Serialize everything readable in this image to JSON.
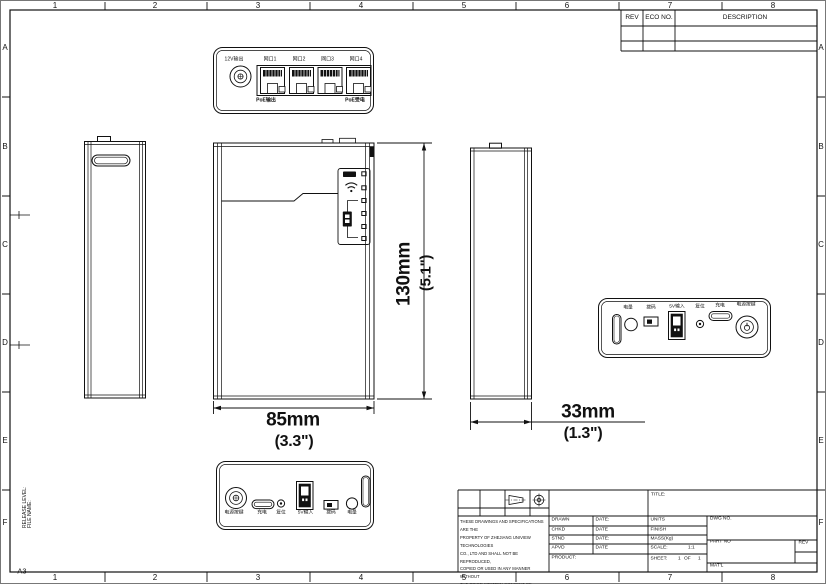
{
  "sheet": {
    "size": "A3",
    "release_level": "RELEASE LEVEL:",
    "file_name": "FILE NAME:",
    "cols": [
      "1",
      "2",
      "3",
      "4",
      "5",
      "6",
      "7",
      "8"
    ],
    "rows": [
      "A",
      "B",
      "C",
      "D",
      "E",
      "F"
    ]
  },
  "rev_table": {
    "rev": "REV",
    "eco_no": "ECO NO.",
    "description": "DESCRIPTION"
  },
  "top_view": {
    "dc_jack": "12V输出",
    "ports": [
      "网口1",
      "网口2",
      "网口3",
      "网口4"
    ],
    "poe_left": "PoE输出",
    "poe_right": "PoE受电"
  },
  "ports_view": {
    "battery": "电量",
    "switch": "拨码",
    "usb_a": "5V输入",
    "reset": "复位",
    "usb_c": "充电",
    "power": "电源按键"
  },
  "bottom_view": {
    "power": "电源按键",
    "usb_c": "充电",
    "reset": "复位",
    "usb_a": "5V输入",
    "switch": "拨码",
    "battery": "电量"
  },
  "dimensions": {
    "height_mm": "130mm",
    "height_in": "(5.1\")",
    "width_mm": "85mm",
    "width_in": "(3.3\")",
    "depth_mm": "33mm",
    "depth_in": "(1.3\")"
  },
  "title_block": {
    "title": "TITLE:",
    "drawn": "DRAWN",
    "drawn_date": "DATE:",
    "chkd": "CHKD",
    "chkd_date": "DATE",
    "stnd": "STND",
    "stnd_date": "DATE:",
    "apvd": "APVD",
    "apvd_date": "DATE",
    "product": "PRODUCT:",
    "units": "UNITS",
    "finish": "FINISH",
    "mass": "MASS(Kg)",
    "scale": "SCALE:",
    "scale_value": "1:1",
    "sheet": "SHEET:",
    "sheet_no": "1",
    "of": "OF",
    "sheet_total": "1",
    "dwg_no": "DWG NO.",
    "part_no": "PART NO",
    "rev": "REV",
    "matl": "MAT'L",
    "notice": [
      "THESE DRAWINGS AND SPECIFICATIONS ARE THE",
      "PROPERTY OF ZHEJIANG UNIVIEW TECHNOLOGIES",
      "CO., LTD AND SHALL NOT BE REPRODUCED,",
      "COPIED OR USED IN ANY MANNER WITHOUT",
      "THE PRIOR WRITTEN CONSENT OF ZHEJIANG",
      "UNIVIEW TECHNOLOGIES CO., LTD"
    ]
  }
}
